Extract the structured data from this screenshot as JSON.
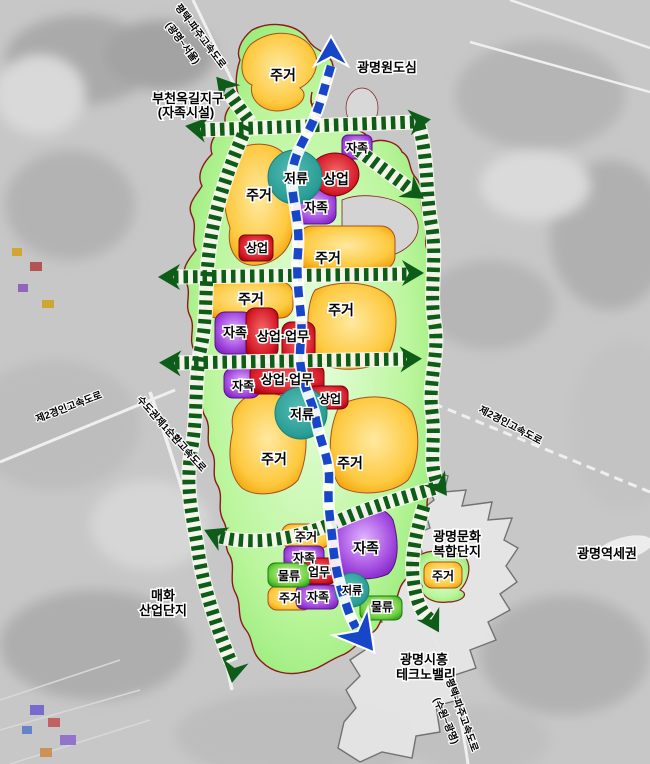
{
  "labels": {
    "residential": "주거",
    "commercial": "상업",
    "self_sufficiency": "자족",
    "detention": "저류",
    "logistics": "물류",
    "business": "업무",
    "commercial_business": "상업·업무"
  },
  "areas": {
    "bucheon_okgil_line1": "부천옥길지구",
    "bucheon_okgil_line2": "(자족시설)",
    "gwangmyeong_original_downtown": "광명원도심",
    "maehwa_line1": "매화",
    "maehwa_line2": "산업단지",
    "culture_complex_line1": "광명문화",
    "culture_complex_line2": "복합단지",
    "station_area": "광명역세권",
    "technovalley_line1": "광명시흥",
    "technovalley_line2": "테크노밸리"
  },
  "roads": {
    "pyeongtaek_paju_north_line1": "평택-파주고속도로",
    "pyeongtaek_paju_north_line2": "(광명~서울)",
    "gyeongin2_west": "제2경인고속도로",
    "capital_ring1": "수도권제1순환고속도로",
    "gyeongin2_east": "제2경인고속도로",
    "pyeongtaek_paju_south_line1": "평택-파주고속도로",
    "pyeongtaek_paju_south_line2": "(수원~광명)"
  },
  "colors": {
    "residential": "#f6a90a",
    "commercial": "#c3001c",
    "self_sufficiency": "#8a2be2",
    "detention": "#2a9d97",
    "logistics": "#47b02d",
    "green_axis": "#0d5c17",
    "transit_axis": "#1747c8",
    "site_green": "#7ce86a",
    "boundary_red": "#8b1a1a"
  }
}
